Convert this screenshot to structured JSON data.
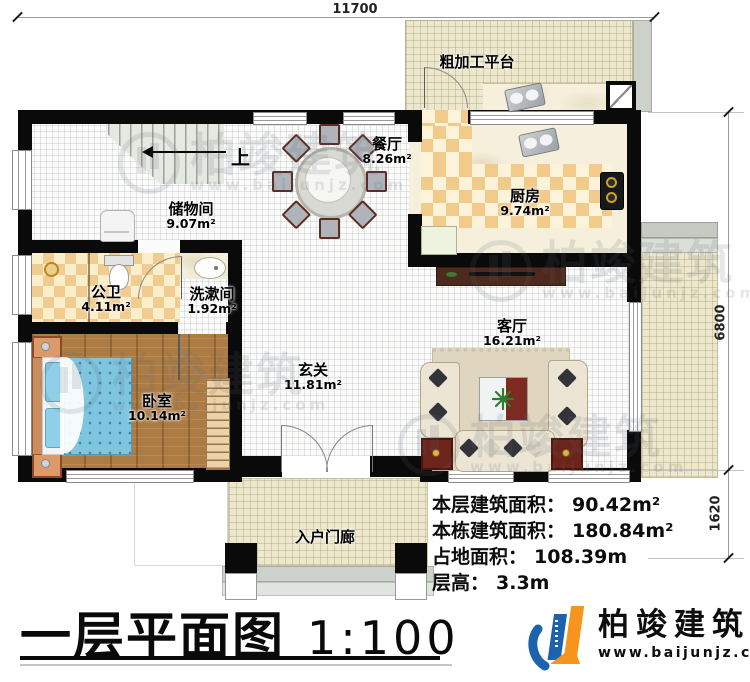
{
  "title_block": {
    "title": "一层平面图",
    "scale": "1:100"
  },
  "footer_logo": {
    "name": "柏竣建筑",
    "url": "www.baijunjz.com"
  },
  "watermark": {
    "text": "柏竣建筑",
    "url": "www.baijunjz.com"
  },
  "dims": {
    "top": "11700",
    "right": "6800",
    "right_lower": "1620"
  },
  "stairs": {
    "label": "上"
  },
  "rooms": {
    "platform": {
      "name": "粗加工平台"
    },
    "dining": {
      "name": "餐厅",
      "area": "8.26m²"
    },
    "kitchen": {
      "name": "厨房",
      "area": "9.74m²"
    },
    "storage": {
      "name": "储物间",
      "area": "9.07m²"
    },
    "public_bath": {
      "name": "公卫",
      "area": "4.11m²"
    },
    "washroom": {
      "name": "洗漱间",
      "area": "1.92m²"
    },
    "hall": {
      "name": "玄关",
      "area": "11.81m²"
    },
    "living": {
      "name": "客厅",
      "area": "16.21m²"
    },
    "bedroom": {
      "name": "卧室",
      "area": "10.14m²"
    },
    "porch": {
      "name": "入户门廊"
    }
  },
  "stats": {
    "floor_area": {
      "label": "本层建筑面积：",
      "value": "90.42m²"
    },
    "total_area": {
      "label": "本栋建筑面积：",
      "value": "180.84m²"
    },
    "land_area": {
      "label": "占地面积：",
      "value": "108.39m"
    },
    "floor_height": {
      "label": "层高：",
      "value": "3.3m"
    }
  }
}
